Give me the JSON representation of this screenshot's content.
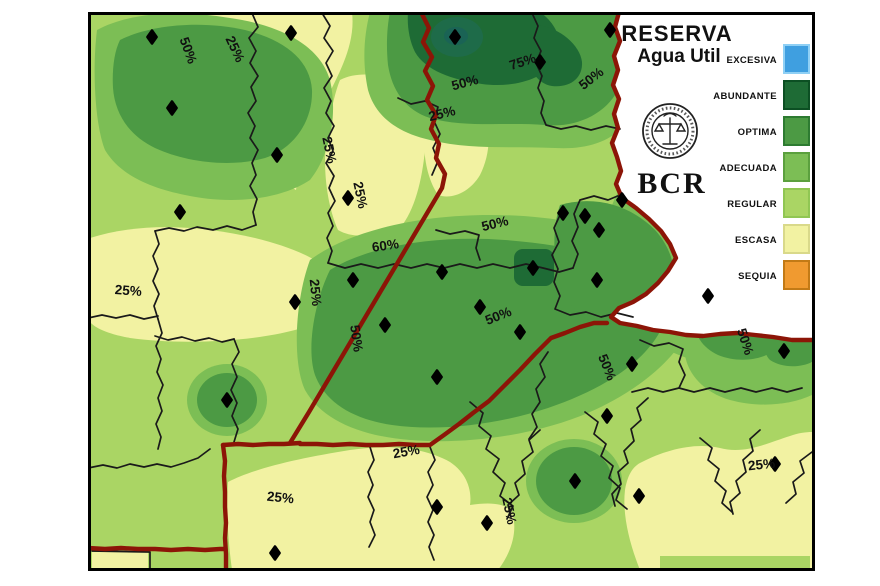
{
  "title": {
    "line1": "RESERVA",
    "line2": "Agua Util",
    "org": "BCR"
  },
  "legend": {
    "items": [
      {
        "label": "EXCESIVA",
        "color": "#3f9fe0",
        "border": "#8fd0f5"
      },
      {
        "label": "ABUNDANTE",
        "color": "#1e6b35",
        "border": "#0c4f23"
      },
      {
        "label": "OPTIMA",
        "color": "#4c9a44",
        "border": "#2d7b31"
      },
      {
        "label": "ADECUADA",
        "color": "#7cbe55",
        "border": "#5ba03e"
      },
      {
        "label": "REGULAR",
        "color": "#aad564",
        "border": "#90c653"
      },
      {
        "label": "ESCASA",
        "color": "#f2f2a2",
        "border": "#d9d98a"
      },
      {
        "label": "SEQUIA",
        "color": "#f09a30",
        "border": "#c27a16"
      }
    ]
  },
  "map": {
    "colors": {
      "regular": "#aad564",
      "escasa": "#f2f2a2",
      "adecuada": "#7cbe55",
      "optima": "#4c9a44",
      "abundante": "#1e6b35",
      "abundante_core": "#1e6b49",
      "abundante_core_dark": "#1a6355",
      "excesiva": "#3f9fe0",
      "sequia": "#f09a30",
      "province_border": "#8c1507",
      "department_border": "#1a1a1a",
      "outside": "#ffffff",
      "station": "#000000"
    },
    "contour_labels": [
      {
        "text": "50%",
        "x": 184,
        "y": 52,
        "rot": 70
      },
      {
        "text": "25%",
        "x": 231,
        "y": 51,
        "rot": 65
      },
      {
        "text": "75%",
        "x": 524,
        "y": 66,
        "rot": -18
      },
      {
        "text": "50%",
        "x": 466,
        "y": 87,
        "rot": -15
      },
      {
        "text": "50%",
        "x": 594,
        "y": 82,
        "rot": -38
      },
      {
        "text": "25%",
        "x": 443,
        "y": 118,
        "rot": -14
      },
      {
        "text": "25%",
        "x": 325,
        "y": 151,
        "rot": 78
      },
      {
        "text": "25%",
        "x": 356,
        "y": 196,
        "rot": 78
      },
      {
        "text": "60%",
        "x": 386,
        "y": 250,
        "rot": -8
      },
      {
        "text": "50%",
        "x": 496,
        "y": 228,
        "rot": -14
      },
      {
        "text": "25%",
        "x": 311,
        "y": 293,
        "rot": 84
      },
      {
        "text": "25%",
        "x": 128,
        "y": 295,
        "rot": 4
      },
      {
        "text": "50%",
        "x": 352,
        "y": 339,
        "rot": 82
      },
      {
        "text": "50%",
        "x": 500,
        "y": 320,
        "rot": -22
      },
      {
        "text": "50%",
        "x": 603,
        "y": 369,
        "rot": 68
      },
      {
        "text": "50%",
        "x": 741,
        "y": 343,
        "rot": 72
      },
      {
        "text": "25%",
        "x": 407,
        "y": 456,
        "rot": -10
      },
      {
        "text": "25%",
        "x": 280,
        "y": 502,
        "rot": 6
      },
      {
        "text": "25%",
        "x": 505,
        "y": 512,
        "rot": 78
      },
      {
        "text": "25%",
        "x": 762,
        "y": 469,
        "rot": -6
      }
    ],
    "stations": [
      [
        152,
        37
      ],
      [
        291,
        33
      ],
      [
        172,
        108
      ],
      [
        277,
        155
      ],
      [
        348,
        198
      ],
      [
        455,
        37
      ],
      [
        540,
        62
      ],
      [
        610,
        30
      ],
      [
        563,
        213
      ],
      [
        585,
        216
      ],
      [
        599,
        230
      ],
      [
        622,
        200
      ],
      [
        442,
        272
      ],
      [
        353,
        280
      ],
      [
        385,
        325
      ],
      [
        480,
        307
      ],
      [
        520,
        332
      ],
      [
        437,
        377
      ],
      [
        533,
        268
      ],
      [
        597,
        280
      ],
      [
        708,
        296
      ],
      [
        180,
        212
      ],
      [
        227,
        400
      ],
      [
        295,
        302
      ],
      [
        275,
        553
      ],
      [
        437,
        507
      ],
      [
        487,
        523
      ],
      [
        575,
        481
      ],
      [
        607,
        416
      ],
      [
        632,
        364
      ],
      [
        639,
        496
      ],
      [
        784,
        351
      ],
      [
        775,
        464
      ]
    ]
  }
}
